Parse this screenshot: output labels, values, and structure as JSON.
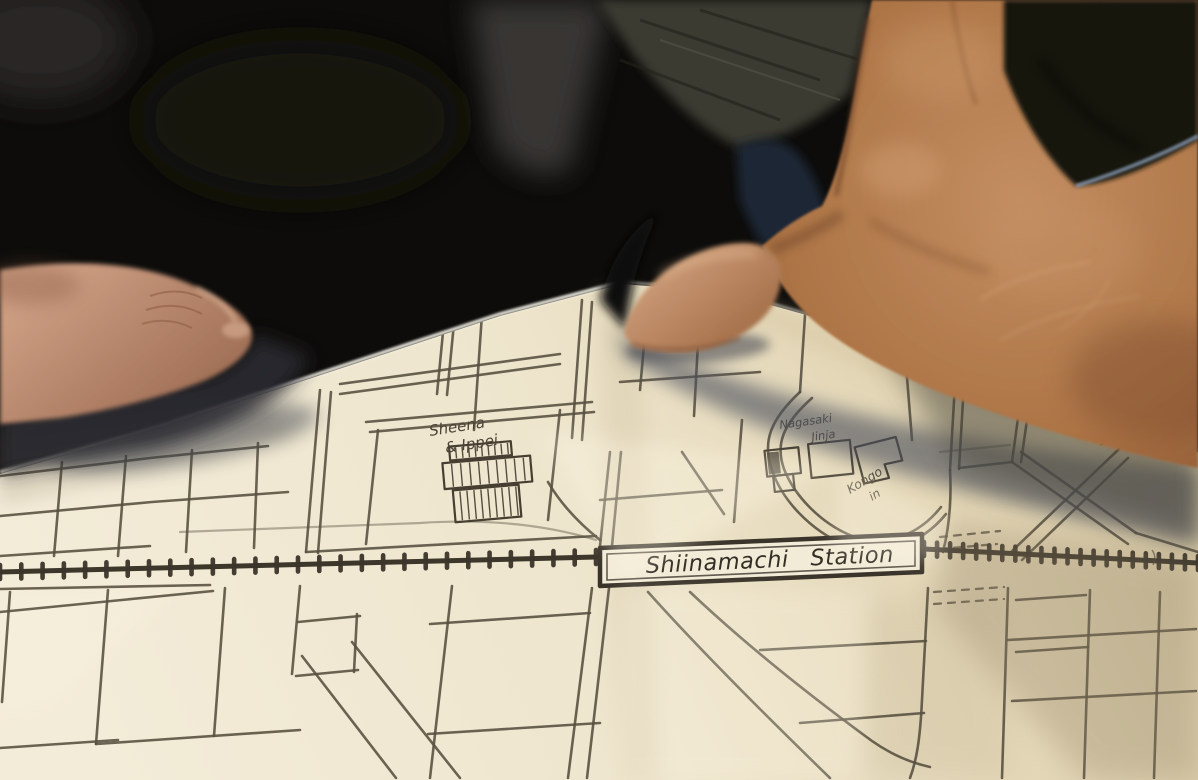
{
  "scene": {
    "type": "photograph",
    "description": "Two hands holding an unfolded hand-drawn paper street map of the area around Shiinamachi Station"
  },
  "palette": {
    "paper": "#efe7d2",
    "paper_shadowed": "#b4a688",
    "ink": "#564e3f",
    "railway_ink": "#3a342a",
    "background": "#0d0c0a",
    "skin_light": "#d2a383",
    "skin_dark": "#8a5432",
    "denim_trim": "#8fa3bd",
    "cast_shadow": "#4e515d"
  },
  "map": {
    "labels": {
      "shop1": {
        "text": "Sheena"
      },
      "shop2": {
        "text": "& Ippei"
      },
      "shrine1": {
        "text": "Nagasaki"
      },
      "shrine2": {
        "text": "Jinja"
      },
      "temple1": {
        "text": "Kongo"
      },
      "temple2": {
        "text": "in"
      },
      "station": {
        "text": "Shiinamachi Station"
      }
    },
    "roads": [
      "M0,476 L150,458 L268,446",
      "M0,516 L152,502 L288,492",
      "M62,462 L54,556",
      "M126,456 L118,556",
      "M192,450 L186,552",
      "M258,443 L254,548",
      "M0,556 L150,546",
      "M320,390 L306,552",
      "M331,392 L318,553",
      "M340,384 L560,354",
      "M340,394 L560,364",
      "M445,312 L437,394",
      "M455,313 L447,395",
      "M482,314 L474,430",
      "M582,300 L572,438",
      "M592,302 L582,440",
      "M366,422 L592,402",
      "M370,432 L594,412",
      "M378,430 L366,544",
      "M560,410 L548,520",
      "M306,552 L596,536",
      "M548,482 C562,506 580,524 600,540",
      "M610,452 L600,546",
      "M621,452 L612,546",
      "M600,500 L722,490",
      "M682,452 L724,514",
      "M742,420 L734,522",
      "M648,300 L640,390",
      "M700,306 L694,416",
      "M620,382 L760,372",
      "M800,392 C770,420 762,442 772,470 C782,500 810,530 845,545 C880,558 920,546 946,514",
      "M812,398 C783,424 775,444 784,469 C794,495 820,523 852,536 C884,548 918,536 941,507",
      "M806,300 L800,392",
      "M905,352 L912,440",
      "M958,332 L950,470",
      "M967,332 L959,469",
      "M950,470 C952,506 948,532 943,552",
      "M1018,418 L1012,462",
      "M1027,420 L1021,462",
      "M1012,462 L1128,544",
      "M1021,452 L1136,533",
      "M1128,458 L1022,560",
      "M1119,449 L1012,551",
      "M959,468 L1012,462",
      "M1136,533 L1198,552",
      "M592,588 L568,778",
      "M609,588 L587,778",
      "M452,586 L430,778",
      "M10,592 L2,702",
      "M108,590 L96,744",
      "M225,588 L214,736",
      "M300,586 L292,674",
      "M0,589 L210,585",
      "M0,612 L213,591",
      "M0,748 L118,740",
      "M96,744 L300,730",
      "M298,622 L360,616",
      "M296,676 L358,670",
      "M357,614 L354,672",
      "M430,624 L590,613",
      "M428,734 L600,723",
      "M302,656 L396,778",
      "M352,642 L460,778",
      "M648,592 C700,650 762,712 830,778",
      "M690,592 C742,641 802,690 872,741 C892,755 912,763 930,767",
      "M760,650 L926,641",
      "M800,723 L924,713",
      "M928,588 L922,700 C920,742 916,762 910,778",
      "M1008,588 L1002,778",
      "M1008,640 L1196,629",
      "M1012,701 L1196,691",
      "M1090,590 L1084,778",
      "M1160,592 L1154,778",
      "M1016,600 L1086,595",
      "M1016,652 L1088,647"
    ],
    "faint_roads": [
      "M920,352 L1000,341",
      "M1040,360 L1150,402",
      "M940,452 L1010,445",
      "M1118,448 L1162,420",
      "M180,532 L420,523 C480,519 540,523 596,540",
      "M1150,430 L1198,452"
    ],
    "dashed_roads": [
      "M940,537 L1000,531",
      "M940,549 L997,544",
      "M934,592 L1004,587",
      "M934,604 L1004,599"
    ],
    "squiggles": [
      "M959,356 c3,5 -2,9 1,14 c3,5 -2,9 1,14 c3,5 -2,9 1,13",
      "M1078,424 q6,-5 12,-1 q6,4 12,0 q6,-4 12,1",
      "M1152,550 q5,7 1,15"
    ],
    "railway": {
      "left": {
        "x1": 0,
        "y1": 572,
        "x2": 596,
        "y2": 557,
        "step": 21
      },
      "right": {
        "x1": 924,
        "y1": 549,
        "x2": 1198,
        "y2": 563,
        "step": 13
      },
      "box": {
        "outer": "600,548 922,534 922,572 600,586",
        "inner": "607,554 915,541 915,566 607,580"
      }
    },
    "shop": {
      "rotate": [
        -5,
        480,
        480
      ],
      "parts": [
        {
          "x": 452,
          "y": 444,
          "w": 62,
          "h": 14,
          "step": 6.5
        },
        {
          "x": 444,
          "y": 460,
          "w": 88,
          "h": 26,
          "step": 9
        },
        {
          "x": 452,
          "y": 488,
          "w": 66,
          "h": 32,
          "step": 7
        }
      ]
    },
    "jinja": {
      "rotate": [
        -6,
        830,
        462
      ],
      "rects": [
        [
          766,
          444,
          34,
          26
        ],
        [
          772,
          470,
          20,
          16
        ],
        [
          810,
          442,
          42,
          34
        ]
      ],
      "solid": [
        768,
        446,
        12,
        22
      ],
      "lshape": "M856,450 L898,444 L902,468 L884,470 L887,484 L862,487 Z"
    },
    "star": {
      "cx": 1106,
      "cy": 438,
      "R": 9.5,
      "r": 4
    }
  }
}
